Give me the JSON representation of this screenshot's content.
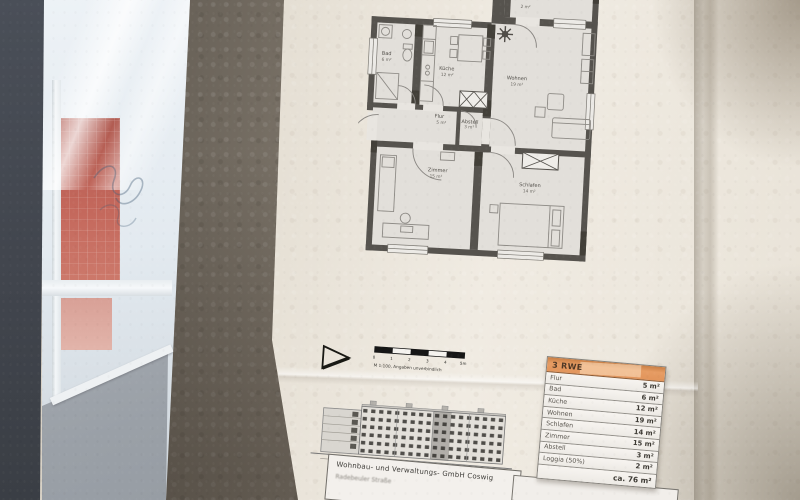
{
  "floor_plan": {
    "rooms": [
      {
        "name": "Bad",
        "area": "6 m²"
      },
      {
        "name": "Küche",
        "area": "12 m²"
      },
      {
        "name": "Flur",
        "area": "5 m²"
      },
      {
        "name": "Abstell",
        "area": "3 m²"
      },
      {
        "name": "Wohnen",
        "area": "19 m²"
      },
      {
        "name": "Zimmer",
        "area": "15 m²"
      },
      {
        "name": "Schlafen",
        "area": "14 m²"
      },
      {
        "name": "Loggia",
        "area": "2 m²"
      }
    ]
  },
  "scale_bar": {
    "ticks": [
      "0",
      "1",
      "2",
      "3",
      "4",
      "5m"
    ],
    "caption": "M 1:100, Angaben unverbindlich"
  },
  "area_table": {
    "header": "3 RWE",
    "header_color": "#e2955c",
    "rows": [
      {
        "label": "Flur",
        "value": "5 m²"
      },
      {
        "label": "Bad",
        "value": "6 m²"
      },
      {
        "label": "Küche",
        "value": "12 m²"
      },
      {
        "label": "Wohnen",
        "value": "19 m²"
      },
      {
        "label": "Schlafen",
        "value": "14 m²"
      },
      {
        "label": "Zimmer",
        "value": "15 m²"
      },
      {
        "label": "Abstell",
        "value": "3 m²"
      },
      {
        "label": "Loggia (50%)",
        "value": "2 m²"
      }
    ],
    "total": "ca. 76 m²"
  },
  "title_block": {
    "company": "Wohnbau- und Verwaltungs- GmbH Coswig",
    "address": "Radebeuler Straße"
  }
}
